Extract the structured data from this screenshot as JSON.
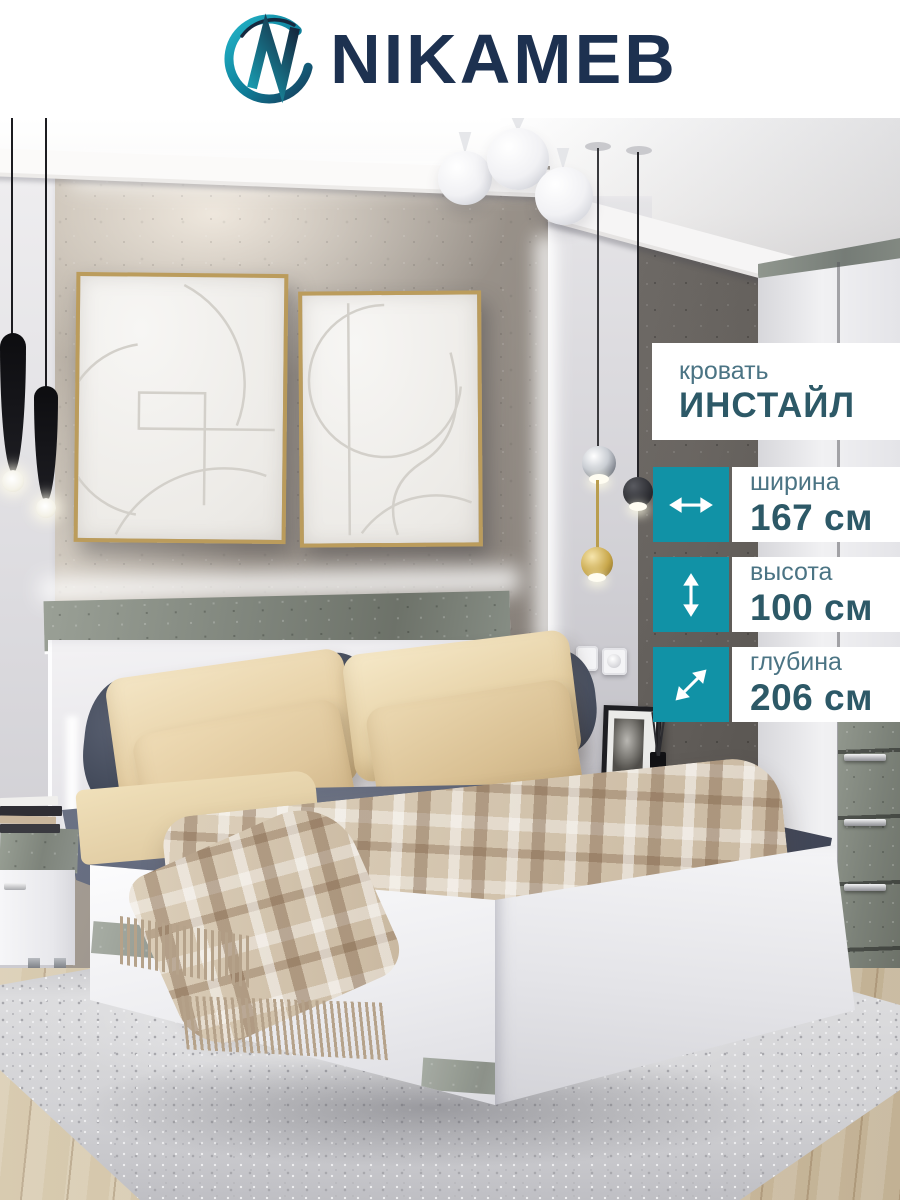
{
  "brand": {
    "name": "NIKAMEB"
  },
  "product": {
    "category": "кровать",
    "name": "ИНСТАЙЛ"
  },
  "dimensions": [
    {
      "icon": "width-arrow-icon",
      "label": "ширина",
      "value": "167 см"
    },
    {
      "icon": "height-arrow-icon",
      "label": "высота",
      "value": "100 см"
    },
    {
      "icon": "depth-arrow-icon",
      "label": "глубина",
      "value": "206 см"
    }
  ],
  "colors": {
    "accent_teal": "#1192a6",
    "text_dark": "#2d5967",
    "label_teal": "#4b7484",
    "logo_navy": "#1d3150"
  }
}
